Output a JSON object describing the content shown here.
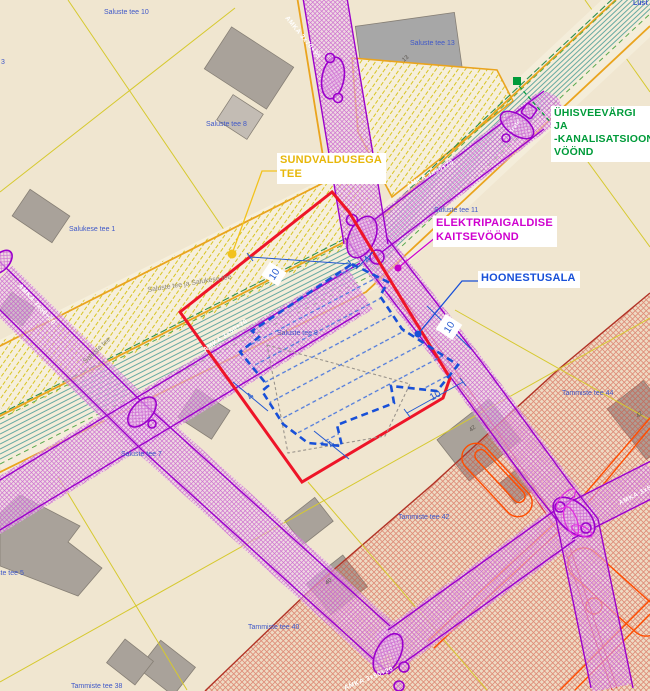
{
  "map": {
    "callouts": {
      "road": {
        "line1": "SUNDVALDUSEGA",
        "line2": "TEE",
        "color": "#e7b70a"
      },
      "water": {
        "line1": "ÜHISVEEVÄRGI",
        "line2": "JA",
        "line3": "-KANALISATSIOONI",
        "line4": "VÖÖND",
        "color": "#009b3a"
      },
      "electric": {
        "line1": "ELEKTRIPAIGALDISE",
        "line2": "KAITSEVÖÖND",
        "color": "#cf00cf"
      },
      "building_area": {
        "line1": "HOONESTUSALA",
        "color": "#1850d8"
      }
    },
    "parcels": [
      {
        "text": "Saluste tee 10"
      },
      {
        "text": "Saluste tee 13"
      },
      {
        "text": "Saluste tee 8"
      },
      {
        "text": "Salukese tee 1"
      },
      {
        "text": "Saluste tee 11"
      },
      {
        "text": "Saluste tee 9"
      },
      {
        "text": "Saluste tee 7"
      },
      {
        "text": "Saluste tee 5"
      },
      {
        "text": "Tammiste tee 44"
      },
      {
        "text": "Tammiste tee 42"
      },
      {
        "text": "Tammiste tee 40"
      },
      {
        "text": "Tammiste tee 38"
      },
      {
        "text": "Lüst"
      },
      {
        "text": "3"
      }
    ],
    "roads": {
      "junction_name": "Saluste tee ja Salukese tee",
      "name": "Saluste tee"
    },
    "cables": {
      "c1": "AMKA 3x70+95",
      "c2": "AMKA 3x50+70",
      "c3": "AMKA 3x50+70",
      "c4": "AMKA 3x50+20",
      "c5": "AMKA 3x50+20",
      "c6": "AMKA 3x50+20"
    },
    "equipment": {
      "transformer": "Trafo"
    },
    "dimensions": {
      "d1": "10",
      "d2": "4",
      "d3": "10",
      "d4": "10",
      "d5": "4",
      "d6": "4"
    },
    "building_numbers": {
      "b13": "13",
      "b40": "40",
      "b42": "42",
      "b42r": "42"
    },
    "colors": {
      "background": "#f0e6d0",
      "parcel_line": "#d6c92f",
      "road_edge_orange": "#eaa41e",
      "water_sewer_teal": "#4f9e98",
      "electric_purple": "#9b00cc",
      "red_boundary": "#ee1528",
      "red_zone_hatch": "#d14a38",
      "heat_pipe_orange": "#ff4d00",
      "parcel_label_blue": "#3f58c8"
    }
  }
}
